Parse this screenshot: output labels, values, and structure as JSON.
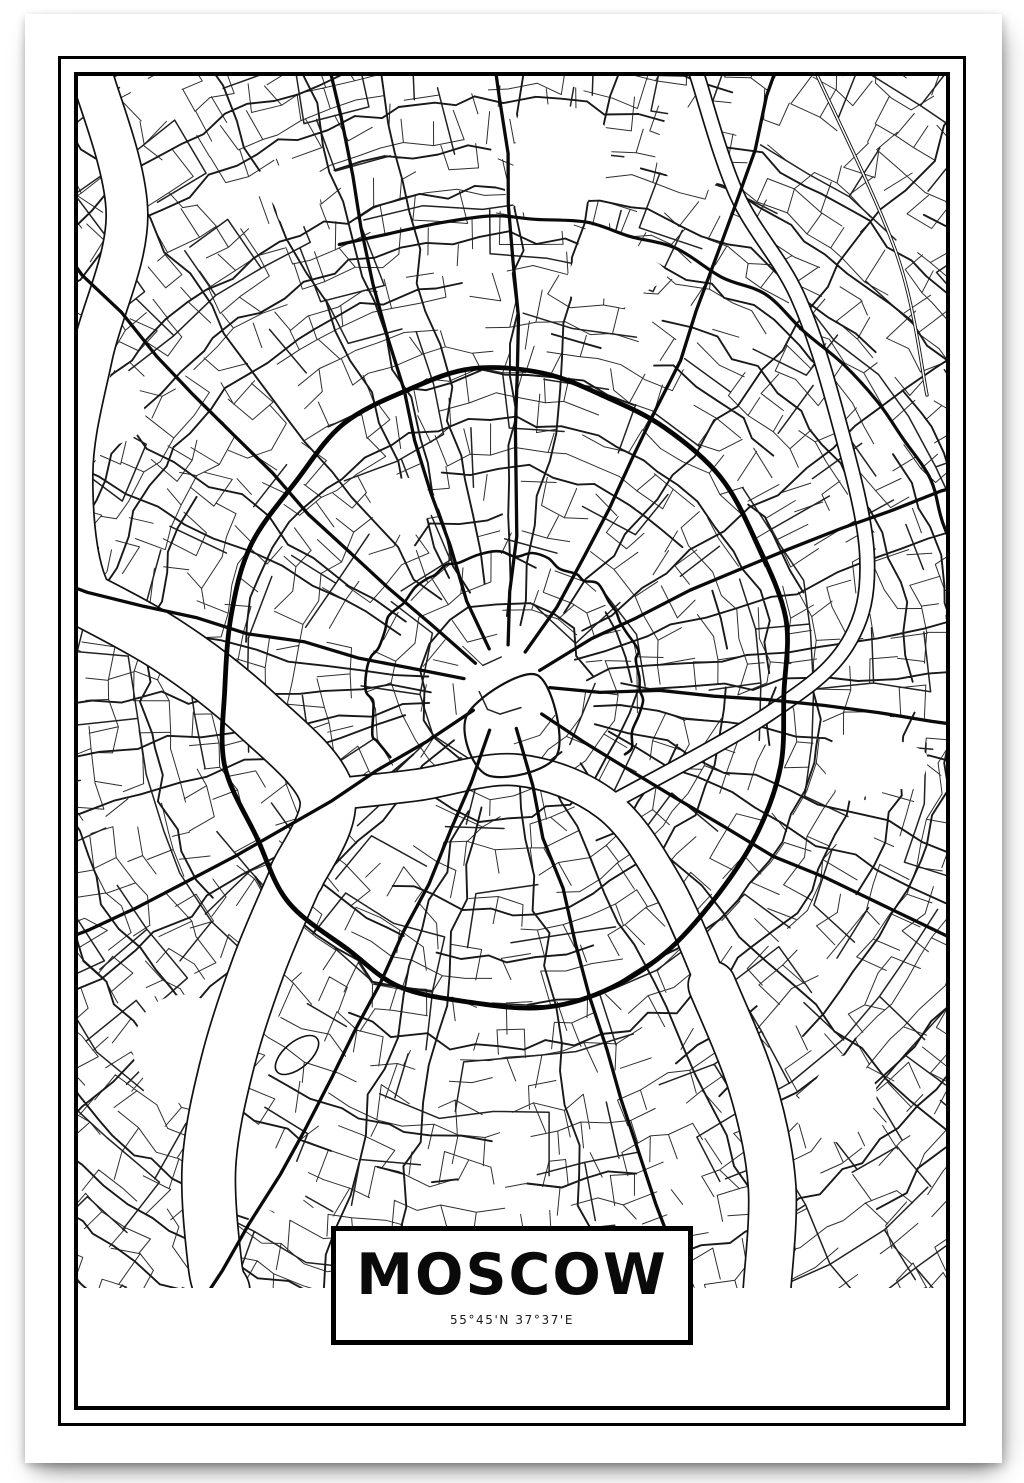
{
  "poster": {
    "title": "MOSCOW",
    "coordinates": "55°45'N 37°37'E"
  },
  "map": {
    "ink": "#111111",
    "paper": "#ffffff",
    "seed": 20,
    "width": 868,
    "height": 1330,
    "content_bottom": 1212,
    "center": [
      427,
      613
    ],
    "garden_ring": {
      "rx": 284,
      "ry": 318,
      "w": 4.8
    },
    "boulevard_ring": {
      "r": 136,
      "a0": 150,
      "a1": 390,
      "w": 2.6
    },
    "ne_arc": {
      "r": 470,
      "a0": 250,
      "a1": 375,
      "w": 3.2
    },
    "avenue_angles_deg": [
      -168,
      -140,
      -112,
      -85,
      -58,
      -30,
      0,
      35,
      75,
      110,
      145
    ],
    "rivers": [
      {
        "name": "upstream",
        "w": 40,
        "pts": [
          [
            14,
            -1
          ],
          [
            49,
            139
          ],
          [
            14,
            279
          ],
          [
            -6,
            399
          ],
          [
            13,
            519
          ],
          [
            89,
            569
          ]
        ]
      },
      {
        "name": "west",
        "w": 54,
        "pts": [
          [
            -21,
            509
          ],
          [
            89,
            569
          ],
          [
            179,
            639
          ],
          [
            249,
            719
          ],
          [
            219,
            799
          ]
        ]
      },
      {
        "name": "center",
        "w": 30,
        "pts": [
          [
            249,
            719
          ],
          [
            339,
            709
          ],
          [
            439,
            694
          ],
          [
            529,
            729
          ],
          [
            589,
            809
          ],
          [
            634,
            909
          ]
        ]
      },
      {
        "name": "southeast",
        "w": 46,
        "pts": [
          [
            634,
            909
          ],
          [
            674,
            1009
          ],
          [
            694,
            1109
          ],
          [
            689,
            1214
          ]
        ]
      },
      {
        "name": "luzhniki-loop",
        "w": 52,
        "pts": [
          [
            219,
            799
          ],
          [
            181,
            889
          ],
          [
            149,
            989
          ],
          [
            131,
            1089
          ],
          [
            137,
            1189
          ],
          [
            145,
            1214
          ]
        ]
      },
      {
        "name": "yauza",
        "w": 13,
        "pts": [
          [
            619,
            -1
          ],
          [
            659,
            119
          ],
          [
            719,
            219
          ],
          [
            759,
            339
          ],
          [
            789,
            479
          ],
          [
            769,
            569
          ],
          [
            689,
            639
          ],
          [
            529,
            729
          ]
        ]
      }
    ],
    "rail": [
      [
        739,
        -1
      ],
      [
        819,
        179
      ],
      [
        849,
        319
      ]
    ],
    "parks": [
      [
        479,
        99,
        60
      ],
      [
        539,
        199,
        45
      ],
      [
        619,
        69,
        40
      ],
      [
        219,
        119,
        38
      ],
      [
        99,
        969,
        55
      ],
      [
        169,
        1099,
        48
      ],
      [
        799,
        679,
        42
      ],
      [
        39,
        339,
        36
      ],
      [
        759,
        1019,
        44
      ],
      [
        329,
        429,
        30
      ]
    ],
    "kremlin": [
      [
        389,
        639
      ],
      [
        459,
        599
      ],
      [
        479,
        679
      ],
      [
        409,
        699
      ]
    ],
    "stadium": [
      219,
      979,
      26,
      13,
      -40
    ]
  }
}
